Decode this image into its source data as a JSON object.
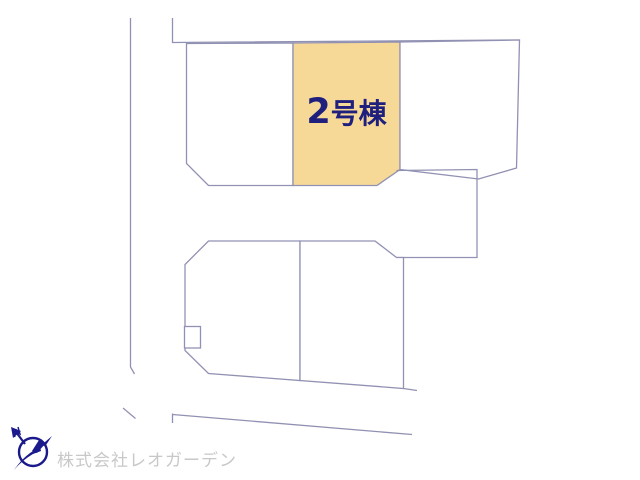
{
  "site_plan": {
    "line_color": "#9191b3",
    "highlighted_plot": {
      "label_full": "2号棟",
      "label_number": "2",
      "label_suffix": "号棟",
      "fill_color": "#f7d997",
      "label_color": "#1f1f7d"
    },
    "plots": [
      {
        "id": "top-left",
        "highlighted": false,
        "label": ""
      },
      {
        "id": "top-center",
        "highlighted": true,
        "label": "2号棟"
      },
      {
        "id": "top-right",
        "highlighted": false,
        "label": ""
      },
      {
        "id": "middle-right",
        "highlighted": false,
        "label": ""
      },
      {
        "id": "bottom-left",
        "highlighted": false,
        "label": ""
      },
      {
        "id": "bottom-center",
        "highlighted": false,
        "label": ""
      }
    ]
  },
  "footer": {
    "company_name": "株式会社レオガーデン",
    "company_text_color": "#c8c8c8",
    "logo_color": "#1a1a8c"
  }
}
